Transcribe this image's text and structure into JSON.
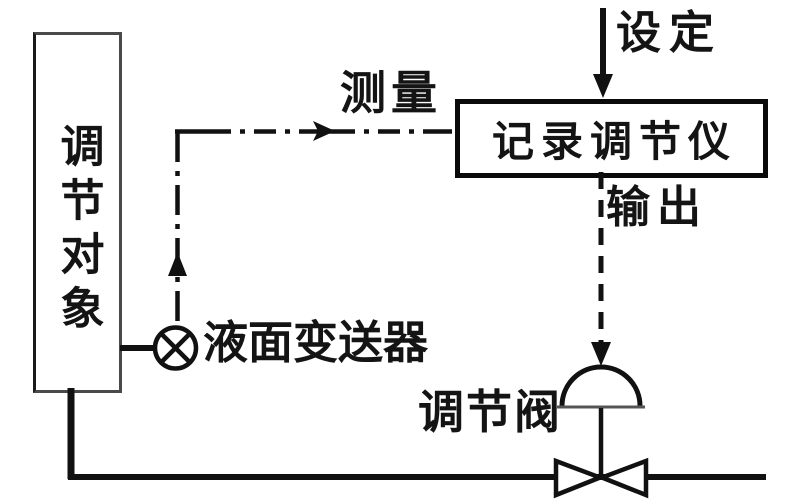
{
  "diagram": {
    "type": "process-control-loop",
    "background_color": "#ffffff",
    "line_color": "#111111",
    "nodes": {
      "controlled_object": {
        "label": "调节对象",
        "shape": "vertical-rectangle"
      },
      "controller": {
        "label": "记录调节仪",
        "shape": "rectangle"
      },
      "transmitter": {
        "label": "液面变送器",
        "shape": "circle-x"
      },
      "valve": {
        "label": "调节阀",
        "shape": "dome-actuator-bowtie-valve"
      }
    },
    "signals": {
      "setpoint": {
        "label": "设定",
        "style": "solid-arrow-into-controller"
      },
      "measurement": {
        "label": "测量",
        "style": "dash-dot-arrow-into-controller"
      },
      "output": {
        "label": "输出",
        "style": "dashed-arrow-into-valve"
      }
    }
  }
}
